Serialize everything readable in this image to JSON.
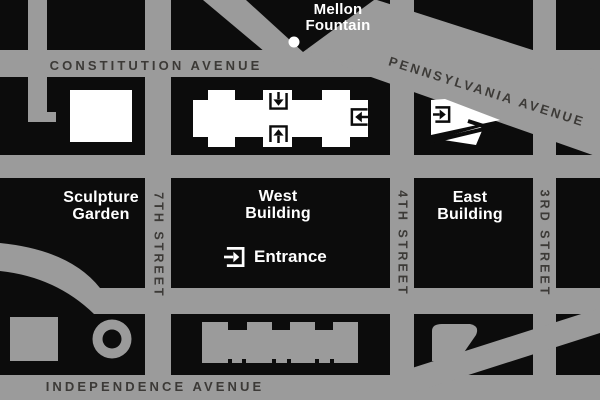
{
  "map": {
    "streets": {
      "constitution_avenue": "CONSTITUTION AVENUE",
      "pennsylvania_avenue": "PENNSYLVANIA AVENUE",
      "independence_avenue": "INDEPENDENCE AVENUE",
      "seventh_street": "7TH STREET",
      "fourth_street": "4TH STREET",
      "third_street": "3RD STREET"
    },
    "landmarks": {
      "mellon_fountain": {
        "line1": "Mellon",
        "line2": "Fountain"
      },
      "sculpture_garden": {
        "line1": "Sculpture",
        "line2": "Garden"
      },
      "west_building": {
        "line1": "West",
        "line2": "Building"
      },
      "east_building": {
        "line1": "East",
        "line2": "Building"
      }
    },
    "legend": {
      "entrance": "Entrance"
    },
    "icons": {
      "entrance_marker": "arrow-into-bracket",
      "mellon_fountain_marker": "white-dot"
    },
    "colors": {
      "street_gray": "#9b9b9b",
      "block_black": "#0c0c0c",
      "highlight_building_white": "#ffffff",
      "muted_building_gray": "#9b9b9b",
      "street_label_dark": "#3c3a37",
      "landmark_label_white": "#ffffff"
    }
  }
}
